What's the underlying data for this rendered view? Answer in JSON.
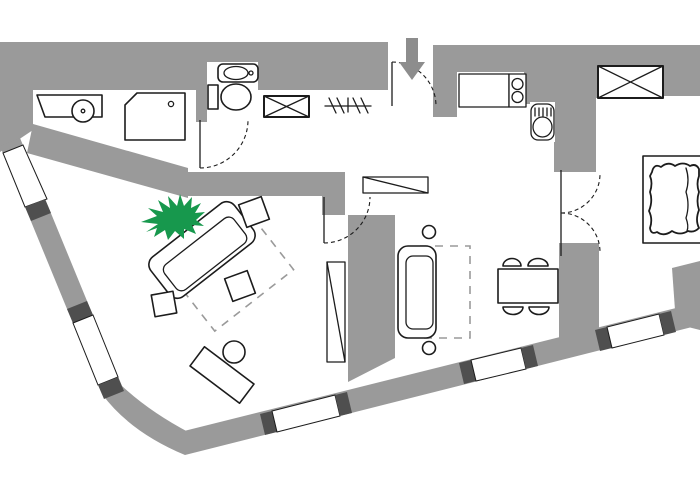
{
  "app": {
    "type": "architectural-floor-plan",
    "title": "Apartment floor plan",
    "visible_text": ""
  },
  "colors": {
    "wall": "#9a9a9a",
    "floor": "#ffffff",
    "outline": "#1c1c1c",
    "window_cap": "#4f4f4f",
    "plant": "#17984d",
    "arrow": "#8d8d8d",
    "dashed": "#9a9a9a"
  },
  "entrance": {
    "indicator": "down-arrow-icon",
    "label": "entrance"
  },
  "rooms": [
    {
      "label": "bathroom"
    },
    {
      "label": "toilet-nook"
    },
    {
      "label": "hallway"
    },
    {
      "label": "kitchen"
    },
    {
      "label": "living-room"
    },
    {
      "label": "dining-sitting-area"
    },
    {
      "label": "bedroom"
    }
  ],
  "furniture": {
    "vanity_basin": {
      "label": "vanity with round basin"
    },
    "shower": {
      "label": "corner shower"
    },
    "toilet": {
      "label": "toilet"
    },
    "hand_sink": {
      "label": "hand wash basin"
    },
    "wardrobe_hall": {
      "label": "hall wardrobe"
    },
    "coat_rack": {
      "label": "coat rack"
    },
    "counter": {
      "label": "kitchen counter"
    },
    "stove": {
      "label": "two-burner stove"
    },
    "kitchen_sink": {
      "label": "kitchen sink"
    },
    "wardrobe_bedroom": {
      "label": "bedroom wardrobe"
    },
    "bed": {
      "label": "double bed with duvet"
    },
    "french_doors": {
      "label": "double doors"
    },
    "dining_table": {
      "label": "dining table with four chairs"
    },
    "sofa_small": {
      "label": "two-seat sofa"
    },
    "side_tables": {
      "label": "round side tables"
    },
    "rug_sitting": {
      "label": "rug (dashed)"
    },
    "sofa_large": {
      "label": "angled sofa"
    },
    "stools": {
      "label": "square side tables"
    },
    "rug_living": {
      "label": "rug (dashed)"
    },
    "plant": {
      "label": "potted plant"
    },
    "desk": {
      "label": "desk with chair"
    },
    "radiator_v": {
      "label": "radiator / shelf (vertical)"
    },
    "sideboard": {
      "label": "sideboard / shelf"
    }
  }
}
